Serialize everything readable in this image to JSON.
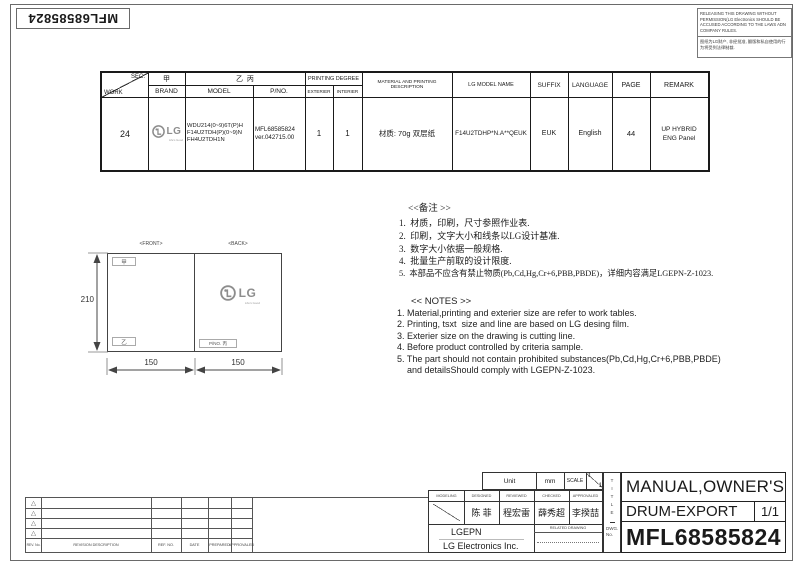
{
  "frame": {
    "doc_number_rotated": "MFL68585824"
  },
  "notice": {
    "line_en": "RELEASING THIS DRAWING WITHOUT PERMISSION(LG Electronics SHOULD BE ACCUSED ACCORDING TO THE LAWS ADN COMPANY RULES.",
    "line_cn": "图纸为LG财产, 非经批准, 翻版和私自使用的行为将受到法律制裁."
  },
  "spec_table": {
    "hdr": {
      "sec": "SEC.",
      "work": "WORK",
      "brand_tag": "甲",
      "brand": "BRAND",
      "model_tag": "乙  丙",
      "model": "MODEL",
      "pno": "P/NO.",
      "printing_degree": "PRINTING DEGREE",
      "exterier": "EXTERIER",
      "interier": "INTERIER",
      "material": "MATERIAL AND PRINTING DESCRIPTION",
      "lg_model_name": "LG MODEL NAME",
      "suffix": "SUFFIX",
      "language": "LANGUAGE",
      "page": "PAGE",
      "remark": "REMARK"
    },
    "row": {
      "work": "24",
      "logo_text": "LG",
      "logo_tagline": "Life's Good",
      "model1": "WDU214(0~9)6T(P)H",
      "model2": "F14U2TDH(P)(0~9)N",
      "model3": "FH4U2TDH1N",
      "pno1": "MFL68585824",
      "pno2": "ver.042715.00",
      "exterier": "1",
      "interier": "1",
      "material": "材质: 70g 双层纸",
      "lg_model_name": "F14U2TDHP*N.A**QEUK",
      "suffix": "EUK",
      "language": "English",
      "page": "44",
      "remark1": "UP HYBRID",
      "remark2": "ENG Panel"
    }
  },
  "drawing": {
    "front_label": "<FRONT>",
    "back_label": "<BACK>",
    "dim_height": "210",
    "dim_front_width": "150",
    "dim_back_width": "150",
    "tag_top": "甲",
    "tag_bottom": "乙",
    "tag_pno": "P/NO. 丙",
    "logo_text": "LG",
    "logo_tagline": "Life's Good"
  },
  "notes_cn": {
    "title": "<<备注 >>",
    "items": [
      "1.  材质，印刷，尺寸参照作业表.",
      "2.  印刷，文字大小和线条以LG设计基准.",
      "3.  数字大小依据一般规格.",
      "4.  批量生产前取的设计限度.",
      "5.  本部品不应含有禁止物质(Pb,Cd,Hg,Cr+6,PBB,PBDE)，详细内容满足LGEPN-Z-1023."
    ]
  },
  "notes_en": {
    "title": "<< NOTES >>",
    "items": [
      "1. Material,printing and exterier size are refer to work tables.",
      "2. Printing, tsxt  size and line are based on LG desing film.",
      "3. Exterier size on the drawing is cutting line.",
      "4. Before product controlled by criteria sample.",
      "5. The part should not contain prohibited substances(Pb,Cd,Hg,Cr+6,PBB,PBDE)",
      "    and detailsShould comply with LGEPN-Z-1023."
    ]
  },
  "revision": {
    "headers": {
      "rev_no": "REV. No.",
      "description": "REVISION DESCRIPTION",
      "ref_no": "REF. NO.",
      "date": "DATE",
      "prepared": "PREPARED",
      "approvaled": "APPROVALED"
    }
  },
  "title_block": {
    "unit_label": "Unit",
    "unit_value": "mm",
    "scale_label": "SCALE",
    "scale_num": "1",
    "scale_den": "1",
    "roles": {
      "modeling": "MODELING",
      "designed": "DESIGNED",
      "reviewed": "REVIEWED",
      "checked": "CHECKED",
      "approvaled": "APPROVALED"
    },
    "names": {
      "designed": "陈 菲",
      "reviewed": "程宏雷",
      "checked": "薛秀超",
      "approvaled": "李揆喆"
    },
    "company": "LGEPN",
    "company_full": "LG Electronics Inc.",
    "related_drawing": "RELATED DRAWING",
    "title_vertical": "TITLE",
    "dwg_label1": "DWG.",
    "dwg_label2": "No.",
    "title_line1": "MANUAL,OWNER'S",
    "title_line2": "DRUM-EXPORT",
    "sheet": "1/1",
    "dwg_no": "MFL68585824"
  },
  "colors": {
    "line": "#333333",
    "logo_gray": "#8d8d8d",
    "text": "#1a1a1a"
  }
}
